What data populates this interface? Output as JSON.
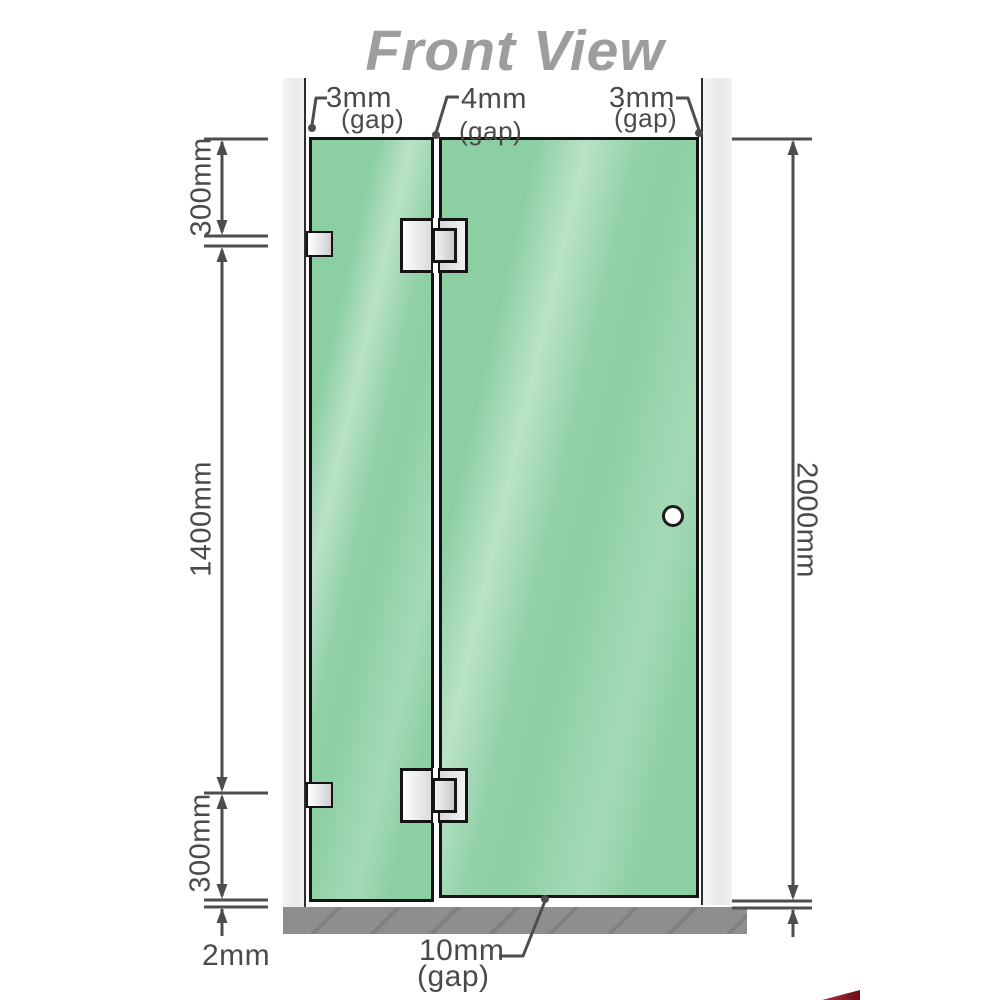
{
  "title": "Front View",
  "annotations": {
    "gap_top_left": {
      "value": "3mm",
      "label": "(gap)"
    },
    "gap_top_middle": {
      "value": "4mm",
      "label": "(gap)"
    },
    "gap_top_right": {
      "value": "3mm",
      "label": "(gap)"
    },
    "gap_bottom": {
      "value": "10mm",
      "label": "(gap)"
    },
    "dim_left_top": "300mm",
    "dim_left_middle": "1400mm",
    "dim_left_bottom": "300mm",
    "dim_floor": "2mm",
    "dim_right": "2000mm"
  },
  "colors": {
    "glass": "#8ccfa3",
    "channel": "#e9e9e9",
    "base": "#8e8e8e",
    "line": "#4d4d4d",
    "label": "#4a4a4a",
    "title": "#9d9d9d",
    "metal": "#e8e8e8",
    "outline": "#141414",
    "accent-red": "#6b0d16"
  }
}
